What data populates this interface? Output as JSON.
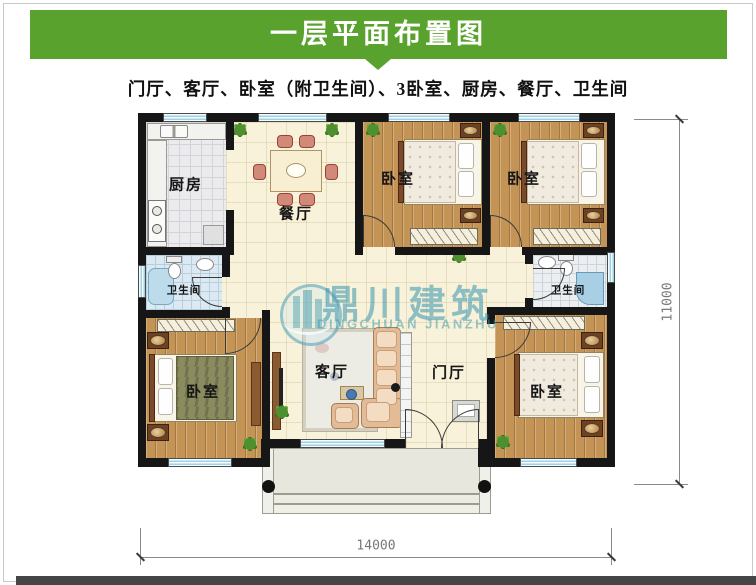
{
  "header": {
    "title": "一层平面布置图",
    "subtitle": "门厅、客厅、卧室（附卫生间）、3卧室、厨房、餐厅、卫生间"
  },
  "watermark": {
    "cn": "鼎川建筑",
    "en": "DINGCHUAN JIANZHU"
  },
  "plan": {
    "rooms": [
      {
        "id": "kitchen",
        "label": "厨房"
      },
      {
        "id": "dining",
        "label": "餐厅"
      },
      {
        "id": "bedroom-top-left",
        "label": "卧室"
      },
      {
        "id": "bedroom-top-right",
        "label": "卧室"
      },
      {
        "id": "bathroom-left",
        "label": "卫生间"
      },
      {
        "id": "bathroom-right",
        "label": "卫生间"
      },
      {
        "id": "bedroom-bottom-left",
        "label": "卧室"
      },
      {
        "id": "living-room",
        "label": "客厅"
      },
      {
        "id": "foyer",
        "label": "门厅"
      },
      {
        "id": "bedroom-bottom-right",
        "label": "卧室"
      }
    ],
    "dimensions": {
      "bottom": "14000",
      "right": "11000"
    }
  },
  "colors": {
    "banner": "#5aa22e",
    "watermark": "#3e98af"
  }
}
